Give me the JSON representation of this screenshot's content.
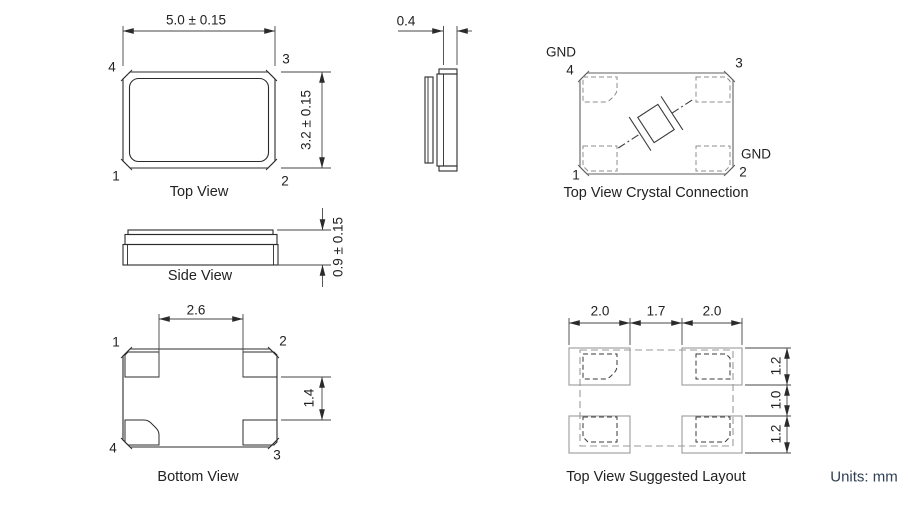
{
  "title": "SMD crystal package mechanical drawing",
  "units_note": "Units: mm",
  "colors": {
    "line": "#2b2b2b",
    "gray": "#9a9a9a",
    "units_text": "#2e4053"
  },
  "views": {
    "top_view": {
      "caption": "Top View",
      "dim_width": "5.0 ± 0.15",
      "dim_height": "3.2 ± 0.15",
      "pins": {
        "top_left": "4",
        "top_right": "3",
        "bottom_left": "1",
        "bottom_right": "2"
      }
    },
    "end_view": {
      "dim_lid_thickness": "0.4"
    },
    "crystal_connection": {
      "caption": "Top View Crystal Connection",
      "gnd_top": "GND",
      "gnd_right": "GND",
      "pins": {
        "top_left": "4",
        "top_right": "3",
        "bottom_left": "1",
        "bottom_right": "2"
      }
    },
    "side_view": {
      "caption": "Side View",
      "dim_height": "0.9 ± 0.15"
    },
    "bottom_view": {
      "caption": "Bottom View",
      "dim_pad_span": "2.6",
      "dim_pad_gap": "1.4",
      "pins": {
        "top_left": "1",
        "top_right": "2",
        "bottom_right": "3",
        "bottom_left": "4"
      }
    },
    "suggested_layout": {
      "caption": "Top View Suggested Layout",
      "dims": {
        "pad_width_left": "2.0",
        "pad_gap": "1.7",
        "pad_width_right": "2.0",
        "pad_height_top": "1.2",
        "row_gap": "1.0",
        "pad_height_bottom": "1.2"
      }
    }
  }
}
